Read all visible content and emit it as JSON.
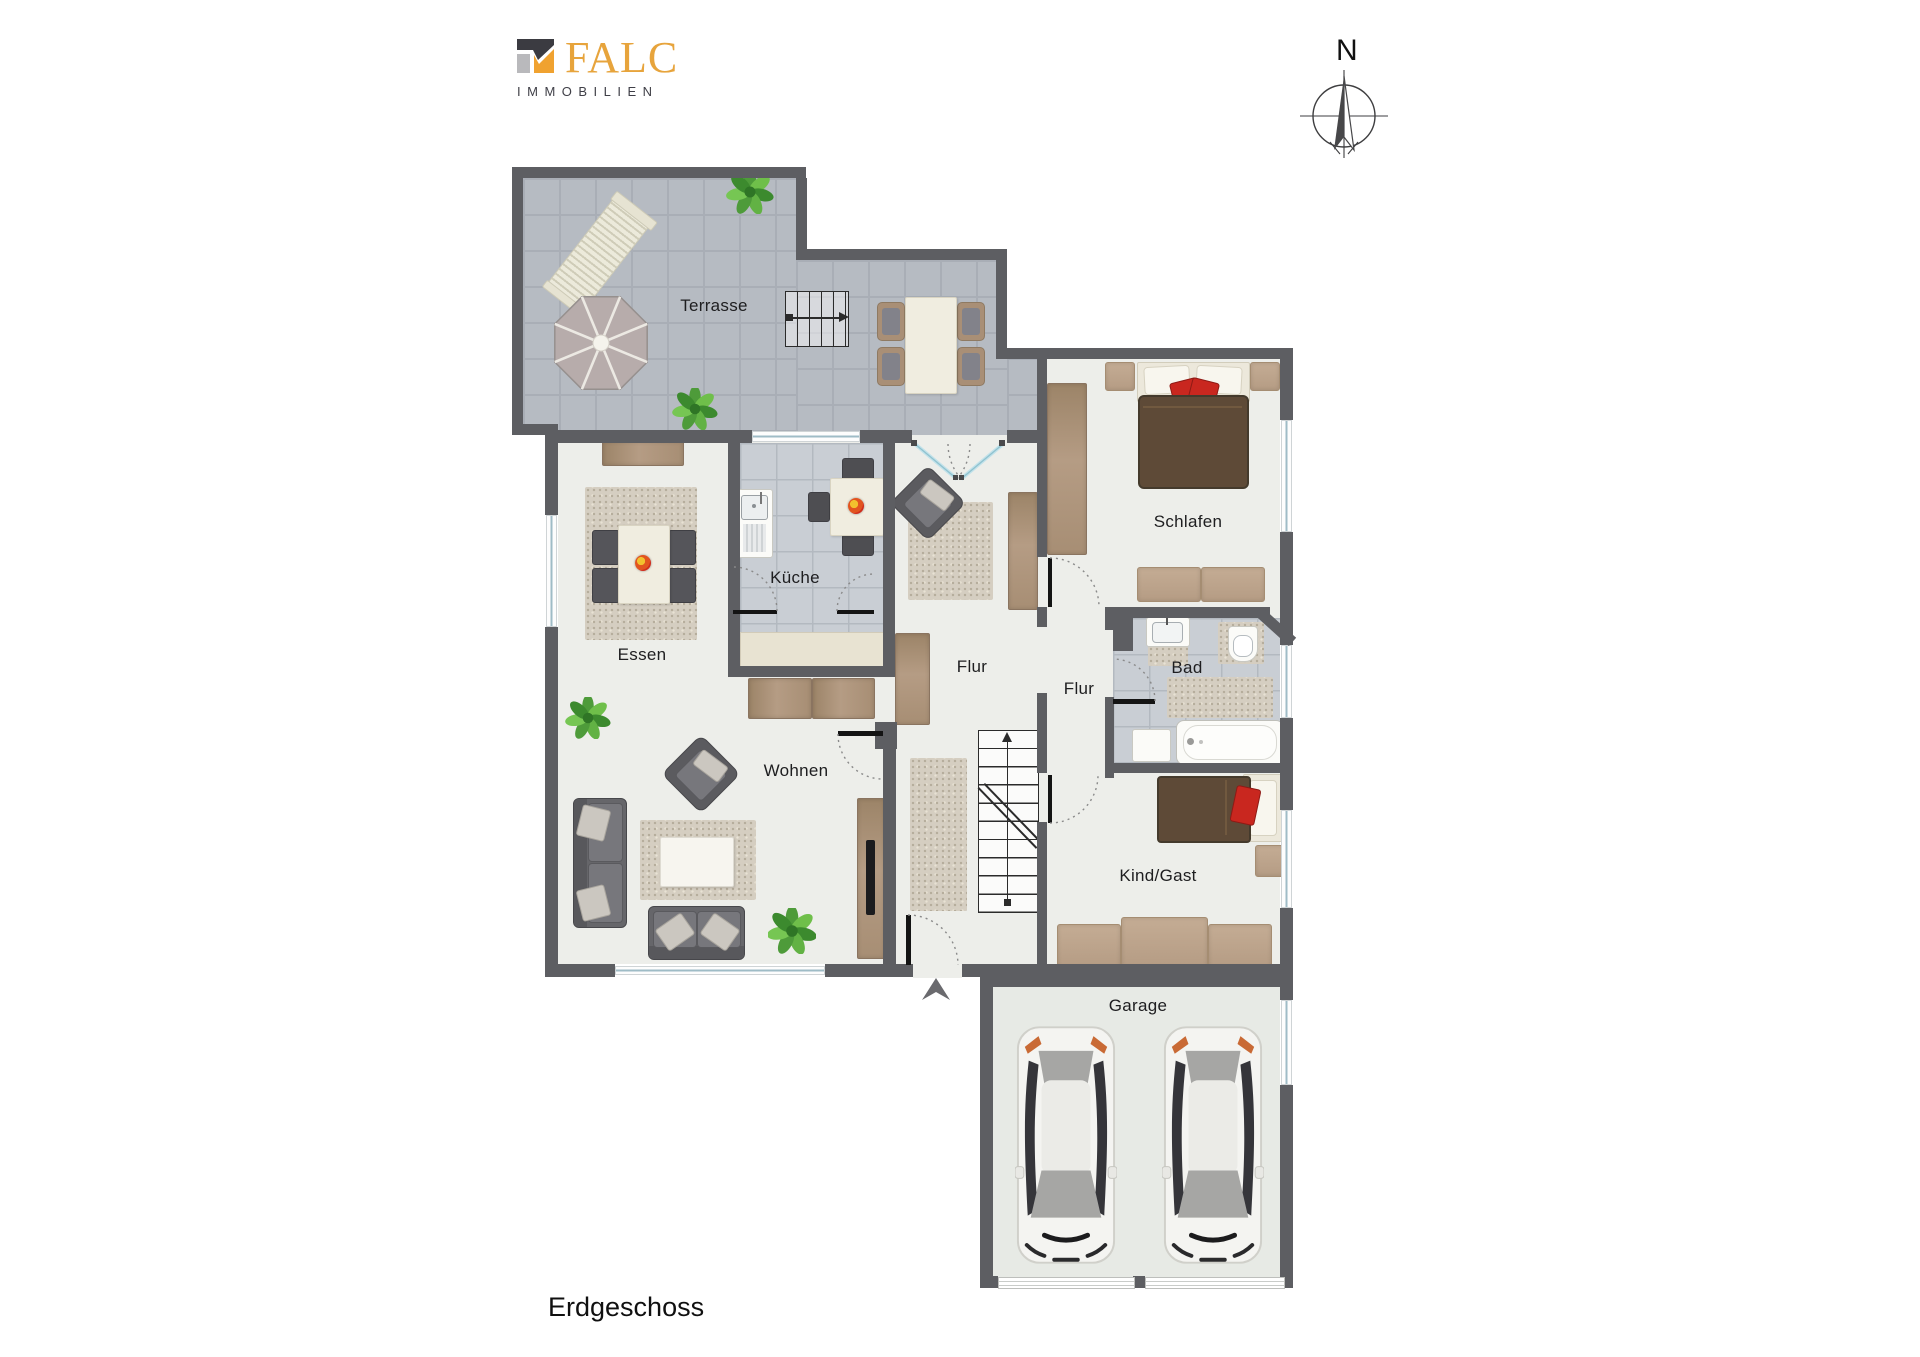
{
  "brand": {
    "name": "FALC",
    "subtitle": "IMMOBILIEN"
  },
  "compass": {
    "label": "N"
  },
  "plan": {
    "floor_label": "Erdgeschoss"
  },
  "rooms": {
    "terrasse": "Terrasse",
    "kueche": "Küche",
    "essen": "Essen",
    "flur_main": "Flur",
    "flur_mid": "Flur",
    "schlafen": "Schlafen",
    "bad": "Bad",
    "wohnen": "Wohnen",
    "kind_gast": "Kind/Gast",
    "garage": "Garage"
  },
  "colors": {
    "wall": "#5d5e62",
    "room_floor": "#edeeea",
    "terrace_tile": "#b6bbc2",
    "kitchen_tile": "#c9ced4",
    "garage_floor": "#e7eae5",
    "wood": "#b59c84",
    "bed_brown": "#5e4a37",
    "pillow_red": "#c9271f",
    "plant_green": "#4e9b3a",
    "brand_orange": "#e7a43c",
    "window_glass": "#9fbcc6"
  }
}
